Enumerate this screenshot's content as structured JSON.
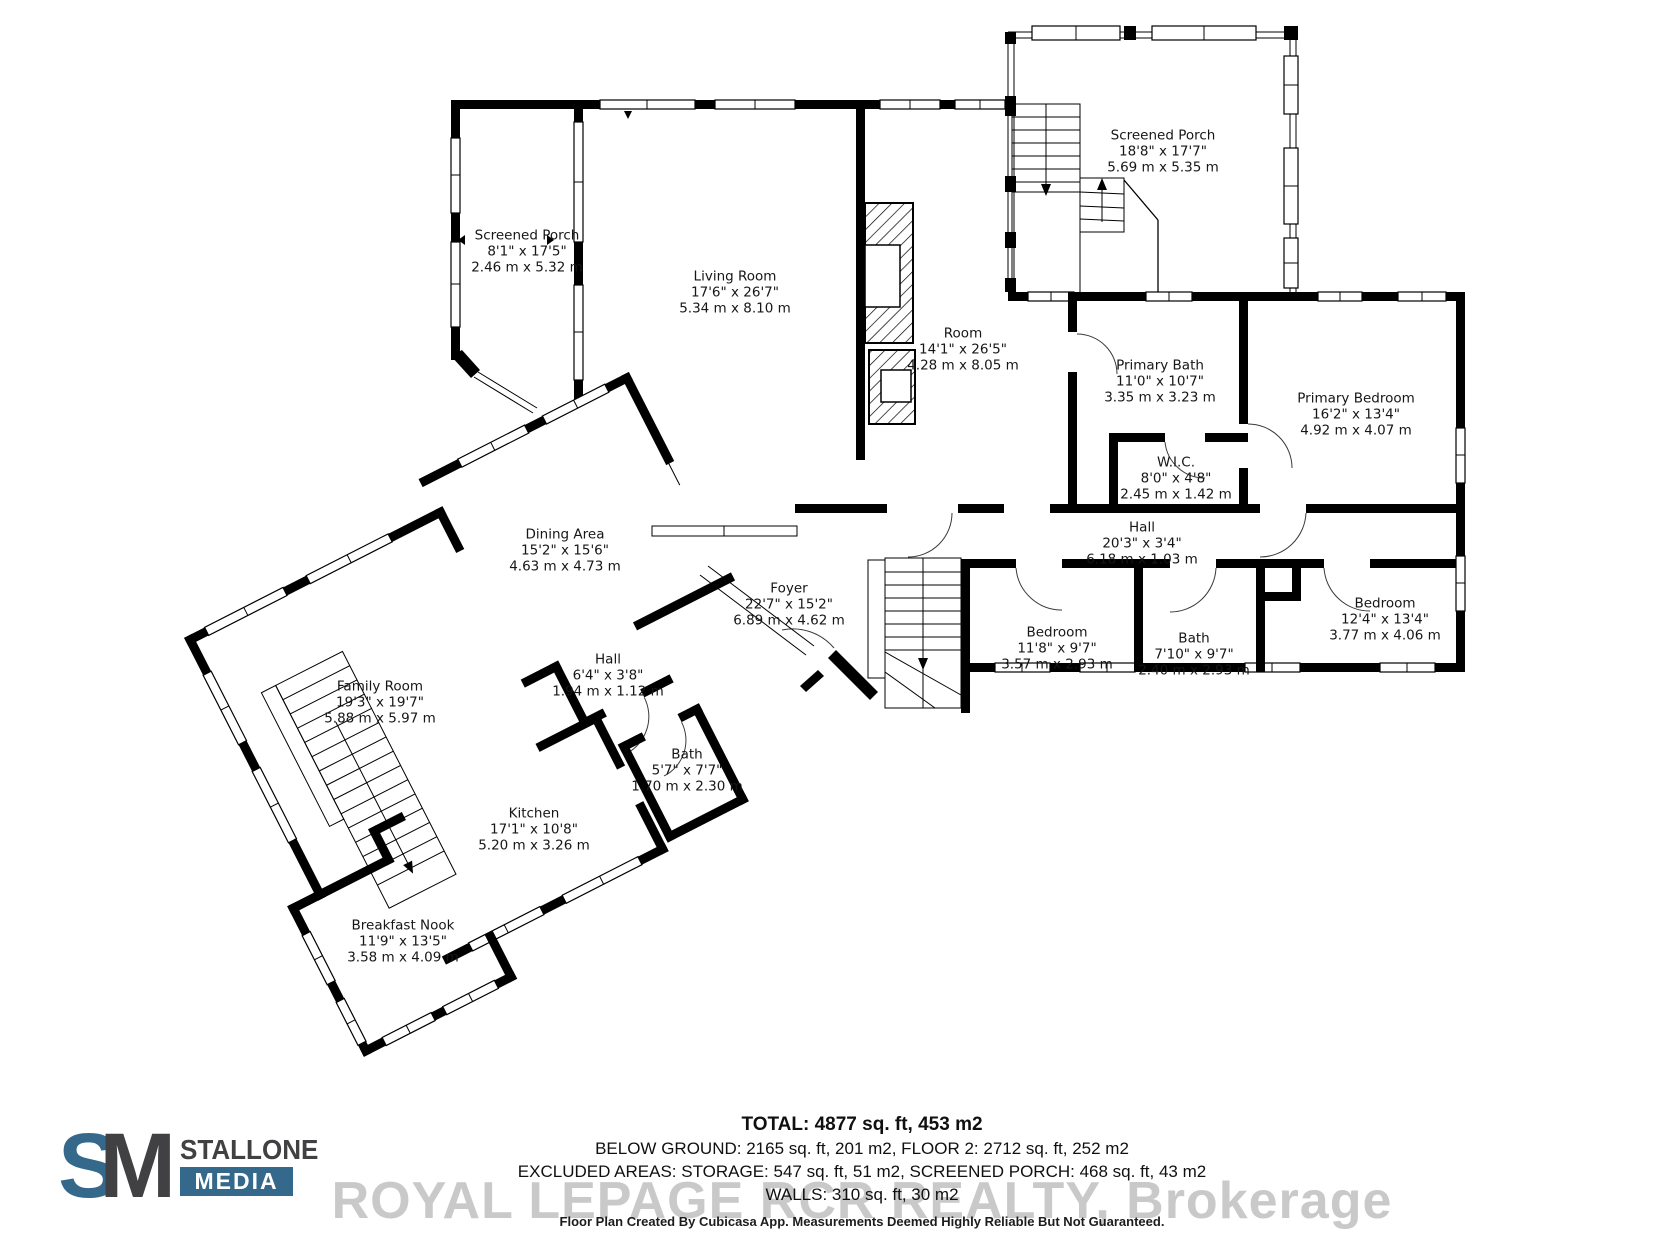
{
  "rooms": [
    {
      "id": "screened-porch-left",
      "name": "Screened Porch",
      "imperial": "8'1\" x 17'5\"",
      "metric": "2.46 m x 5.32 m"
    },
    {
      "id": "living-room",
      "name": "Living Room",
      "imperial": "17'6\" x 26'7\"",
      "metric": "5.34 m x 8.10 m"
    },
    {
      "id": "screened-porch-right",
      "name": "Screened Porch",
      "imperial": "18'8\" x 17'7\"",
      "metric": "5.69 m x 5.35 m"
    },
    {
      "id": "room",
      "name": "Room",
      "imperial": "14'1\" x 26'5\"",
      "metric": "4.28 m x 8.05 m"
    },
    {
      "id": "primary-bath",
      "name": "Primary Bath",
      "imperial": "11'0\" x 10'7\"",
      "metric": "3.35 m x 3.23 m"
    },
    {
      "id": "wic",
      "name": "W.I.C.",
      "imperial": "8'0\" x 4'8\"",
      "metric": "2.45 m x 1.42 m"
    },
    {
      "id": "primary-bedroom",
      "name": "Primary Bedroom",
      "imperial": "16'2\" x 13'4\"",
      "metric": "4.92 m x 4.07 m"
    },
    {
      "id": "hall-upper",
      "name": "Hall",
      "imperial": "20'3\" x 3'4\"",
      "metric": "6.18 m x 1.03 m"
    },
    {
      "id": "bedroom-1",
      "name": "Bedroom",
      "imperial": "11'8\" x 9'7\"",
      "metric": "3.57 m x 2.93 m"
    },
    {
      "id": "bath-upper",
      "name": "Bath",
      "imperial": "7'10\" x 9'7\"",
      "metric": "2.40 m x 2.93 m"
    },
    {
      "id": "bedroom-2",
      "name": "Bedroom",
      "imperial": "12'4\" x 13'4\"",
      "metric": "3.77 m x 4.06 m"
    },
    {
      "id": "dining-area",
      "name": "Dining Area",
      "imperial": "15'2\" x 15'6\"",
      "metric": "4.63 m x 4.73 m"
    },
    {
      "id": "foyer",
      "name": "Foyer",
      "imperial": "22'7\" x 15'2\"",
      "metric": "6.89 m x 4.62 m"
    },
    {
      "id": "family-room",
      "name": "Family Room",
      "imperial": "19'3\" x 19'7\"",
      "metric": "5.88 m x 5.97 m"
    },
    {
      "id": "hall-lower",
      "name": "Hall",
      "imperial": "6'4\" x 3'8\"",
      "metric": "1.94 m x 1.12 m"
    },
    {
      "id": "bath-lower",
      "name": "Bath",
      "imperial": "5'7\" x 7'7\"",
      "metric": "1.70 m x 2.30 m"
    },
    {
      "id": "kitchen",
      "name": "Kitchen",
      "imperial": "17'1\" x 10'8\"",
      "metric": "5.20 m x 3.26 m"
    },
    {
      "id": "breakfast-nook",
      "name": "Breakfast Nook",
      "imperial": "11'9\" x 13'5\"",
      "metric": "3.58 m x 4.09 m"
    }
  ],
  "footer": {
    "total": "TOTAL: 4877 sq. ft, 453 m2",
    "below_ground": "BELOW GROUND: 2165 sq. ft, 201 m2, FLOOR 2: 2712 sq. ft, 252 m2",
    "excluded": "EXCLUDED AREAS: STORAGE: 547 sq. ft, 51 m2, SCREENED PORCH: 468 sq. ft, 43 m2",
    "walls": "WALLS: 310 sq. ft, 30 m2",
    "watermark": "ROYAL LEPAGE RCR REALTY, Brokerage",
    "disclaimer": "Floor Plan Created By Cubicasa App. Measurements Deemed Highly Reliable But Not Guaranteed."
  },
  "logo": {
    "s": "S",
    "m": "M",
    "stallone": "STALLONE",
    "media": "MEDIA"
  },
  "colors": {
    "accent": "#34698c",
    "dark": "#414042",
    "wall": "#000000",
    "watermark": "#c9c9c9"
  }
}
